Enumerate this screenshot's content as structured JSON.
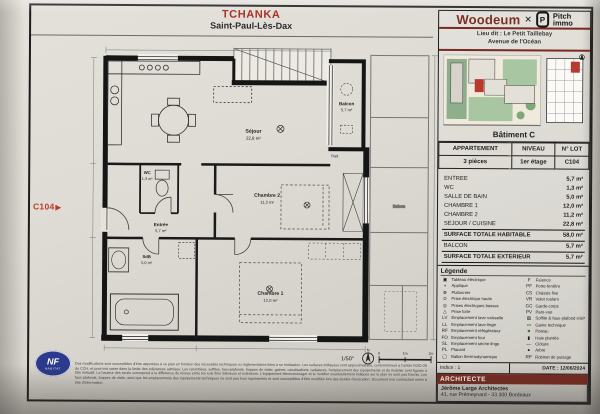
{
  "title": {
    "project": "TCHANKA",
    "city": "Saint-Paul-Lès-Dax"
  },
  "branding": {
    "brand1": "Woodeum",
    "separator": "✕",
    "mark_letter": "P",
    "brand2_line1": "Pitch",
    "brand2_line2": "immo"
  },
  "location": {
    "line1": "Lieu dit : Le Petit Taillebay",
    "line2": "Avenue de l'Océan"
  },
  "building": {
    "caption": "Bâtiment C"
  },
  "apartment_table": {
    "headers": [
      "APPARTEMENT",
      "NIVEAU",
      "N° LOT"
    ],
    "row": [
      "3 pièces",
      "1er étage",
      "C104"
    ]
  },
  "surfaces": {
    "rows": [
      {
        "label": "ENTREE",
        "value": "5,7  m²"
      },
      {
        "label": "WC",
        "value": "1,3  m²"
      },
      {
        "label": "SALLE DE BAIN",
        "value": "5,0  m²"
      },
      {
        "label": "CHAMBRE 1",
        "value": "12,0 m²"
      },
      {
        "label": "CHAMBRE 2",
        "value": "11,2 m²"
      },
      {
        "label": "SEJOUR / CUISINE",
        "value": "22,8 m²"
      }
    ],
    "total_habitable": {
      "label": "SURFACE TOTALE HABITABLE",
      "value": "58,0 m²"
    },
    "balcon": {
      "label": "BALCON",
      "value": "5,7  m²"
    },
    "total_exterieur": {
      "label": "SURFACE TOTALE EXTERIEUR",
      "value": "5,7 m²"
    }
  },
  "legend": {
    "title": "Légende",
    "left": [
      {
        "icon": "▣",
        "label": "Tableau électrique"
      },
      {
        "icon": "◖",
        "label": "Applique"
      },
      {
        "icon": "⊕",
        "label": "Plafonnier"
      },
      {
        "icon": "⊙",
        "label": "Prise électrique haute"
      },
      {
        "icon": "◎",
        "label": "Prises électriques basses"
      },
      {
        "icon": "△",
        "label": "Prise forte"
      },
      {
        "icon": "LV",
        "label": "Emplacement lave-vaisselle"
      },
      {
        "icon": "LL",
        "label": "Emplacement lave-linge"
      },
      {
        "icon": "RF",
        "label": "Emplacement réfrigérateur"
      },
      {
        "icon": "FO",
        "label": "Emplacement four"
      },
      {
        "icon": "SL",
        "label": "Emplacement sèche-linge"
      },
      {
        "icon": "PL",
        "label": "Placard"
      },
      {
        "icon": "◯",
        "label": "Ballon thermodynamique"
      }
    ],
    "right": [
      {
        "icon": "F",
        "label": "Faïence"
      },
      {
        "icon": "PF",
        "label": "Porte-fenêtre"
      },
      {
        "icon": "CS",
        "label": "Châssis fixe"
      },
      {
        "icon": "VR",
        "label": "Volet roulant"
      },
      {
        "icon": "GC",
        "label": "Garde-corps"
      },
      {
        "icon": "PV",
        "label": "Pare-vue"
      },
      {
        "icon": "▨",
        "label": "Soffite & faux-plafond HSP 220"
      },
      {
        "icon": "▭",
        "label": "Gaine technique"
      },
      {
        "icon": "■",
        "label": "Poteau"
      },
      {
        "icon": "▮",
        "label": "Haie plantée"
      },
      {
        "icon": "—",
        "label": "Clôture"
      },
      {
        "icon": "●",
        "label": "Arbre"
      },
      {
        "icon": "RP",
        "label": "Robinet de puisage"
      }
    ]
  },
  "revision": {
    "indice": "Indice : 1",
    "date": "DATE : 12/06/2024"
  },
  "architect": {
    "header": "ARCHITECTE",
    "name": "Jérôme Large Architectes",
    "address": "41, rue Prémeynard - 33 300 Bordeaux"
  },
  "plan": {
    "unit_tag": "C104",
    "rad_label": "Rad.",
    "rooms": {
      "sejour": {
        "name": "Séjour",
        "area": "22,8 m²"
      },
      "balcon": {
        "name": "Balcon",
        "area": "5,7 m²"
      },
      "chambre2": {
        "name": "Chambre 2",
        "area": "11,2 m²"
      },
      "chambre1": {
        "name": "Chambre 1",
        "area": "12,0 m²"
      },
      "entree": {
        "name": "Entrée",
        "area": "5,7 m²"
      },
      "wc": {
        "name": "WC",
        "area": "1,3 m²"
      },
      "sdb": {
        "name": "SdB",
        "area": "5,0 m²"
      }
    }
  },
  "scale": {
    "ratio": "1/50°",
    "ticks": [
      "0",
      "1m",
      "2m"
    ],
    "north": "N"
  },
  "nf_logo": {
    "line1": "NF",
    "line2": "HABITAT"
  },
  "disclaimer": "Des modifications sont susceptibles d'être apportées à ce plan en fonction des nécessités techniques ou réglementaires liées à sa réalisation. Les surfaces indiquées sont approximatives, conformément à l'article R261-26 du CCH, et pourront varier dans la limite des tolérances admises. Les retombées, soffites, faux-plafonds, trappes de visite, gaines, canalisations, radiateurs, l'emplacement des équipements et du mobilier sont figurés à titre indicatif. La hauteur des seuils correspond à la différence de niveau entre les sols finis intérieurs et extérieurs. L'équipement électroménager et le mobilier éventuellement indiqués sur le plan ne sont pas fournis. Les faux plafonds, trappes de visite, ainsi que les emplacements des équipements techniques ne sont pas tous représentés et sont susceptibles d'être modifiés lors des études d'exécution. Document non contractuel remis à titre d'information."
}
